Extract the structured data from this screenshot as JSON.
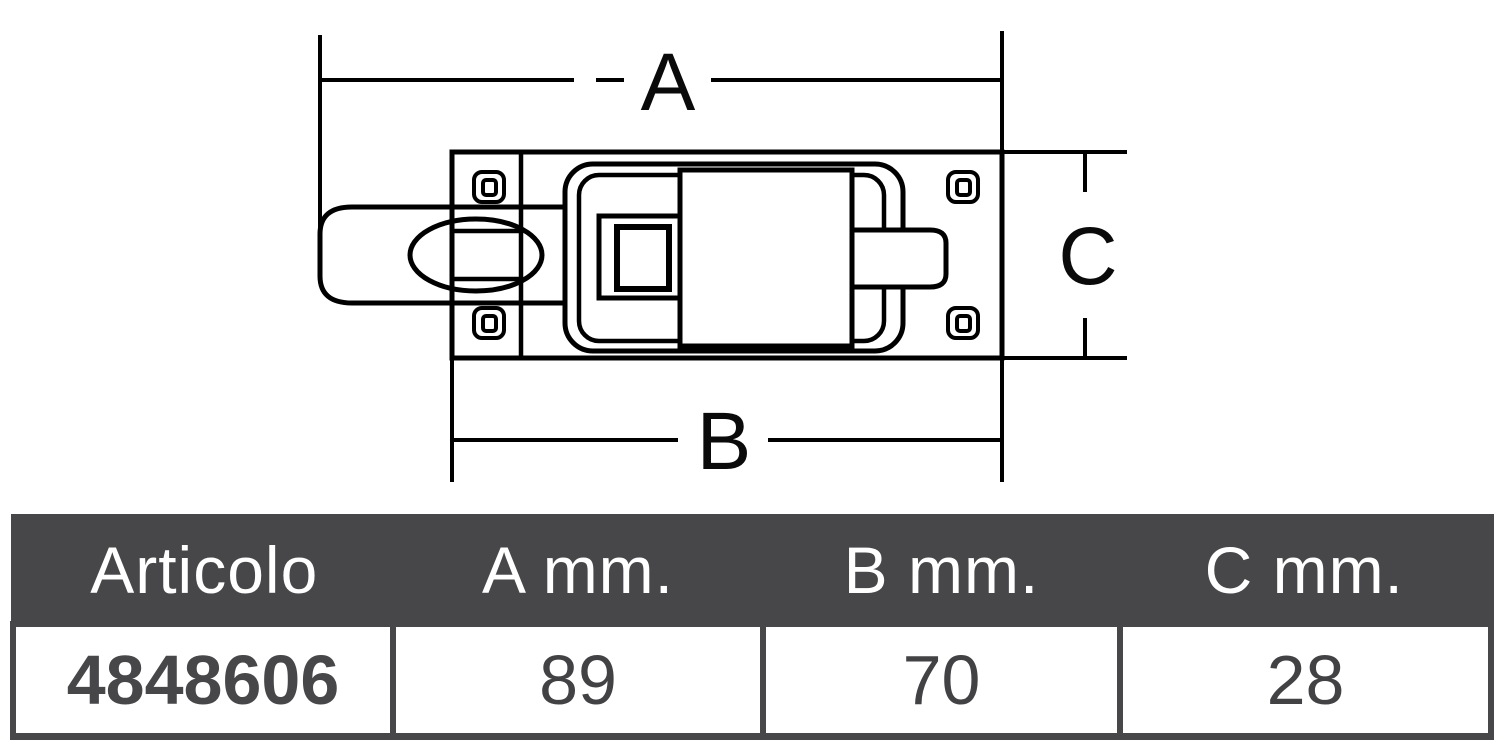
{
  "drawing": {
    "labels": {
      "a": "A",
      "b": "B",
      "c": "C"
    }
  },
  "table": {
    "headers": {
      "article": "Articolo",
      "a": "A mm.",
      "b": "B mm.",
      "c": "C mm."
    },
    "row": {
      "article": "4848606",
      "a": "89",
      "b": "70",
      "c": "28"
    }
  },
  "colors": {
    "line": "#000000",
    "table_dark": "#47474a",
    "table_text_light": "#ffffff",
    "value_text": "#424245",
    "background": "#ffffff"
  }
}
